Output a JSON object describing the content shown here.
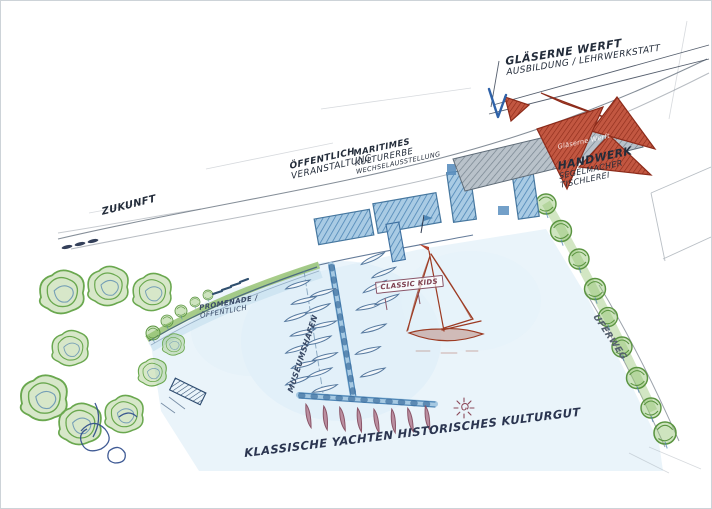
{
  "labels": {
    "future": "ZUKUNFT",
    "shipyard_title": "GLÄSERNE WERFT",
    "shipyard_sub": "AUSBILDUNG / LEHRWERKSTATT",
    "public_line1": "ÖFFENTLICH",
    "public_line2": "VERANSTALTUNG",
    "maritime_line1": "MARITIMES",
    "maritime_line2": "KULTURERBE",
    "maritime_line3": "WECHSELAUSSTELLUNG",
    "craft_line1": "HANDWERK",
    "craft_line2": "SEGELMACHER",
    "craft_line3": "TISCHLEREI",
    "promenade_line1": "PROMENADE /",
    "promenade_line2": "ÖFFENTLICH",
    "classic_kids": "CLASSIC KIDS",
    "harbor": "MUSEUMSHAFEN",
    "shore_path": "UFERWEG",
    "caption": "KLASSISCHE YACHTEN HISTORISCHES KULTURGUT",
    "roof_watermark": "Gläserne Werft"
  },
  "colors": {
    "ink": "#2e3a4e",
    "water": "#eaf4fa",
    "tree_green": "#6aa84f",
    "roof_red": "#b5432f",
    "roof_gray": "#9aa6b0",
    "pier_blue": "#4e86b6",
    "boat_maroon": "#bb8ea0",
    "yacht_sketch_red": "#9c3a22",
    "scribble_blue": "#2c4a8a"
  }
}
